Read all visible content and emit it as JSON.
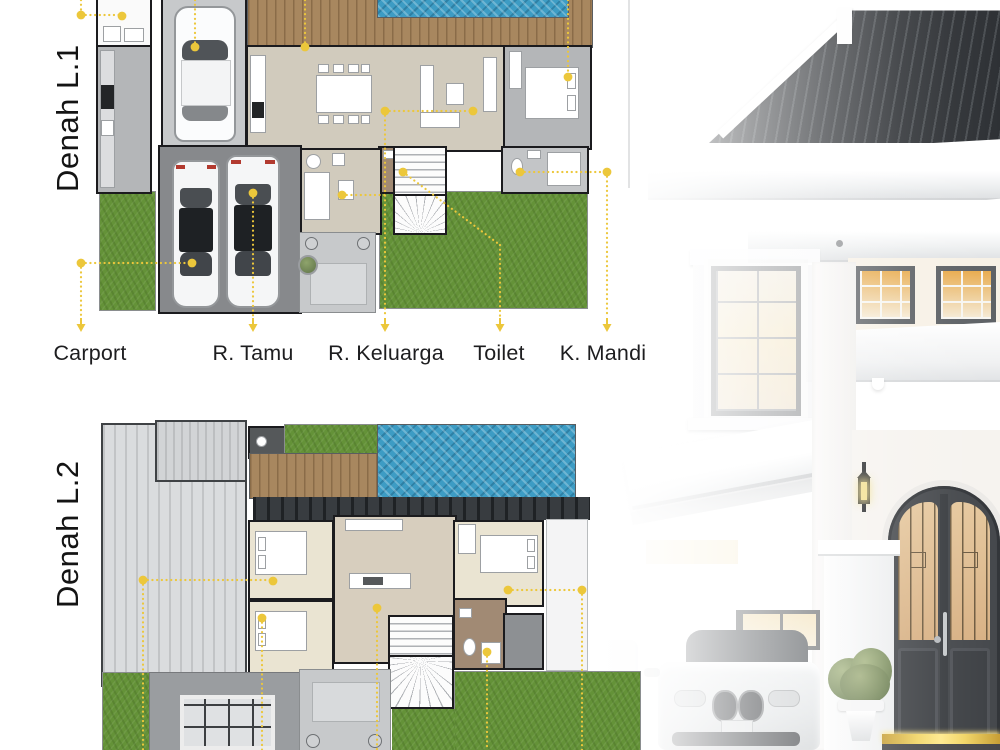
{
  "poster": {
    "background": "#FFFFFF",
    "accent_yellow": "#ECC73B",
    "plan1": {
      "title": "Denah L.1",
      "labels": [
        "Carport",
        "R. Tamu",
        "R. Keluarga",
        "Toilet",
        "K. Mandi"
      ]
    },
    "plan2": {
      "title": "Denah L.2"
    },
    "palette": {
      "wall_line": "#1B1B1E",
      "pool_blue": "#3D9CC4",
      "grass_green": "#649238",
      "deck_wood": "#A8875F",
      "floor_beige": "#D1CBBD",
      "floor_cream": "#EAE4D2",
      "floor_gray": "#B4B6B8",
      "carport_gray": "#87898C",
      "render_roof": "#303438",
      "render_door": "#45484C",
      "door_glass_warm": "#DDBC8F",
      "step_glow_gold": "#F2D566"
    }
  }
}
